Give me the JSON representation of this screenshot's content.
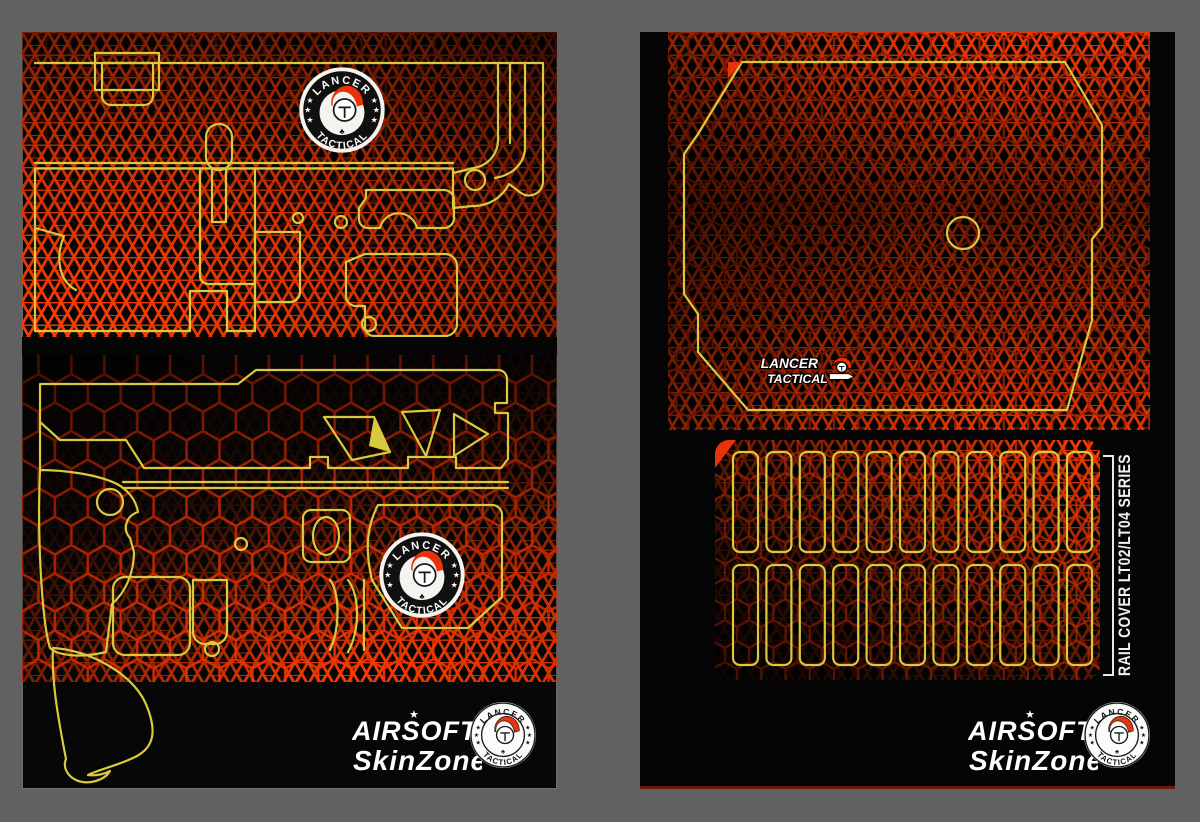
{
  "background": {
    "color": "#616161"
  },
  "brand": {
    "airsoft": "AIRSOFT",
    "skinzone": "SkinZone",
    "lancer": "LANCER",
    "tactical": "TACTICAL"
  },
  "badge": {
    "top_text": "LANCER",
    "bottom_text": "TACTICAL",
    "stars_per_side": 3,
    "helmet_icon": "spartan-helmet-icon",
    "club_glyph": "♣"
  },
  "left_sheet": {
    "content": "receiver skin template with upper and lower receiver cut outlines",
    "badge_count": 2
  },
  "right_sheet": {
    "content": "receiver wrap and rail cover skin template",
    "rail_label": "RAIL COVER LT02/LT04 SERIES",
    "rail_rows": 2,
    "rail_slots_per_row": 11
  },
  "colors": {
    "bg": "#616161",
    "panel": "#070707",
    "yellow": "#d9c93f",
    "red": "#e8320c",
    "pat_bright": "#ff3c02",
    "hex_left": "#f13005",
    "hex_right": "#c22606"
  }
}
